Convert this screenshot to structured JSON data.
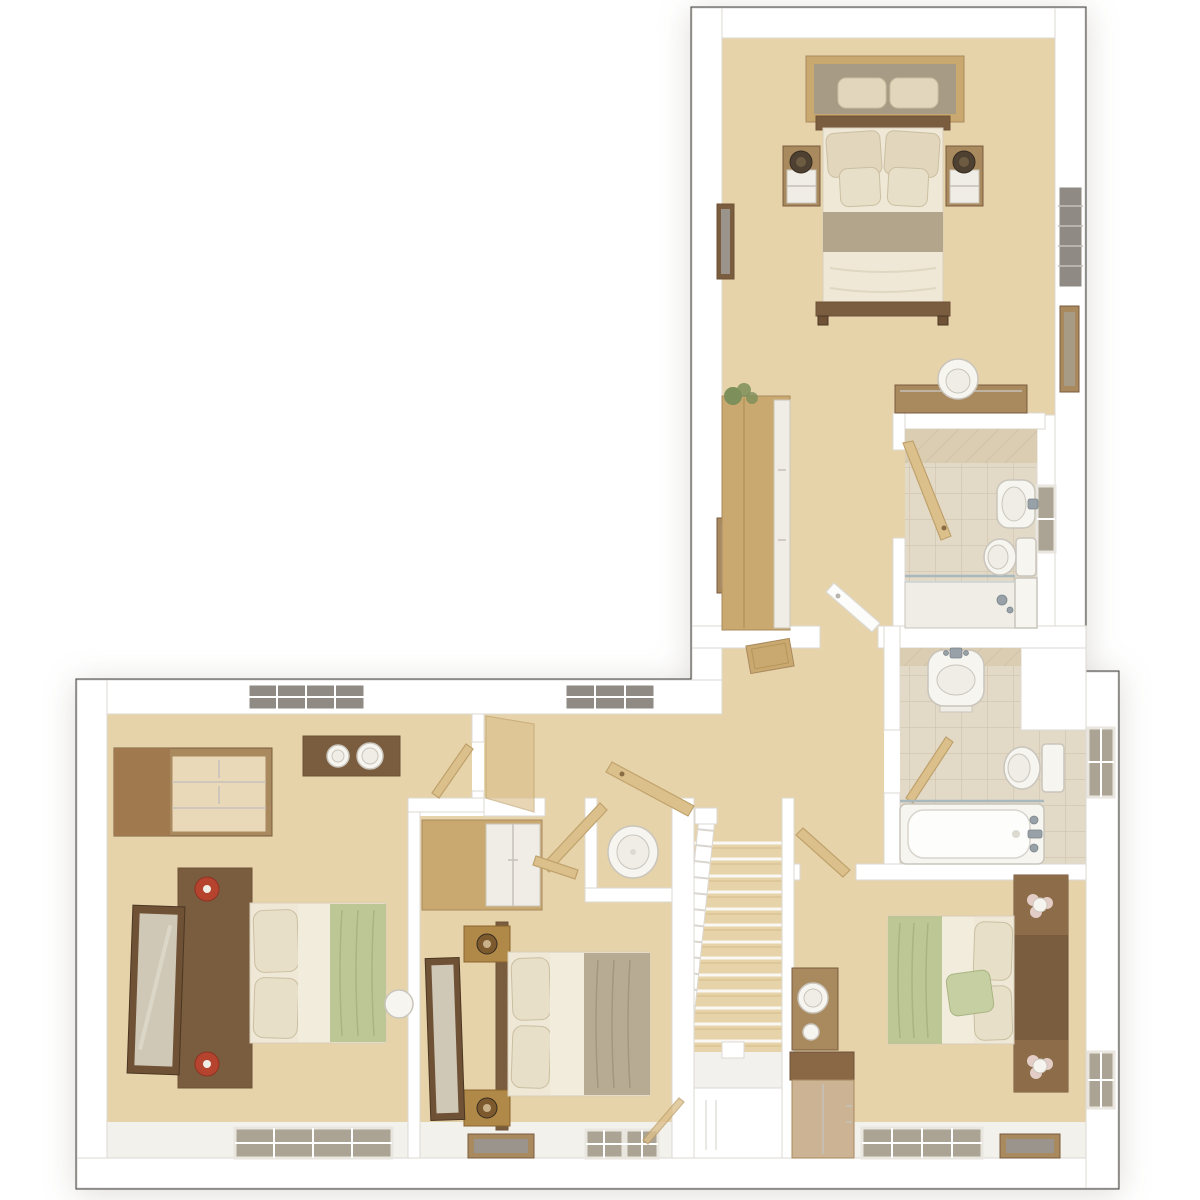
{
  "page": {
    "background": "#ffffff"
  },
  "palette": {
    "outline": "#3f3e3c",
    "wall": "#ffffff",
    "wallEdge": "#dcd9d3",
    "carpet": "#e7d3a9",
    "carpetShade": "#d9c292",
    "sill": "#f3f1ec",
    "tileFloor": "#e3d9c7",
    "tileGrout": "#d0c4ac",
    "tileWall": "#dbcdb2",
    "woodLight": "#c9a96f",
    "woodMid": "#a9895e",
    "woodDark": "#7a5c3e",
    "woodWalnut": "#6f5136",
    "woodGold": "#b08848",
    "woodPanel": "#cbb394",
    "doorWood": "#dcc08c",
    "doorEdge": "#bfa26c",
    "fixtureWhite": "#f7f5f0",
    "fixtureStroke": "#c9c5bc",
    "cream": "#efe8d6",
    "creamEdge": "#d8cfba",
    "creamLight": "#f2ecdc",
    "pillow": "#e2d7bc",
    "pillowLight": "#e8dfc8",
    "pillowEdge": "#cbbfa2",
    "taupe": "#b3a58c",
    "duvetTaupe": "#b7ab94",
    "green": "#bdc795",
    "greenDark": "#a9b482",
    "greenPillow": "#c6cfa2",
    "lampRed": "#b5432e",
    "lampBronze": "#4f4132",
    "chrome": "#98a1a7",
    "glassBlue": "#a9b8bc",
    "mirrorGlass": "#cfc8b6",
    "windowDark": "#8f8b84",
    "windowPane": "#aba393",
    "artGray": "#9a948c",
    "frameInner": "#a79b85",
    "plantGreen": "#7d8f5a"
  },
  "plan": {
    "type": "3d-dollhouse-floor-plan",
    "view": "top-down",
    "rooms": [
      {
        "id": "master-bedroom",
        "label": "Master bedroom with double bed, two bedside tables with lamps, wall mirror, dressing-area wardrobe, desk, chair and plant"
      },
      {
        "id": "en-suite",
        "label": "En-suite shower room with shower enclosure, wash basin and WC"
      },
      {
        "id": "landing",
        "label": "Landing with staircase, airing cupboard, loft hatch and window"
      },
      {
        "id": "family-bathroom",
        "label": "Family bathroom with bath, wash basin, WC and window"
      },
      {
        "id": "bedroom-2",
        "label": "Bedroom 2 with double bed, headboard shelves with lamps, dressing table, cabinet and windows"
      },
      {
        "id": "bedroom-3",
        "label": "Bedroom 3 with double bed, red lamps, chest of drawers, wall shelf, leaning mirror and windows"
      },
      {
        "id": "bedroom-4",
        "label": "Bedroom 4 with double bed, bedside chests, built-in wardrobe, leaning mirror and windows"
      }
    ]
  }
}
